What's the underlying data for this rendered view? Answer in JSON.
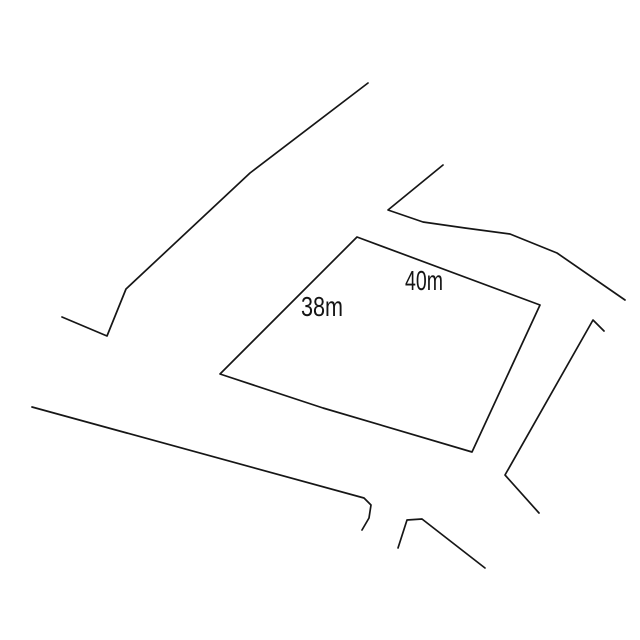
{
  "canvas": {
    "width": 640,
    "height": 640,
    "background": "#ffffff"
  },
  "drawing": {
    "description": "land-parcel-sketch",
    "stroke_color": "#161616",
    "stroke_width": 1.7,
    "polylines": [
      {
        "name": "road-line-upper-left",
        "closed": false,
        "points": [
          [
            368,
            83
          ],
          [
            250,
            173
          ],
          [
            126,
            289
          ],
          [
            107,
            336
          ],
          [
            62,
            317
          ]
        ]
      },
      {
        "name": "road-line-upper-right",
        "closed": false,
        "points": [
          [
            443,
            165
          ],
          [
            388,
            210
          ],
          [
            423,
            222
          ],
          [
            465,
            228
          ],
          [
            510,
            234
          ],
          [
            557,
            253
          ],
          [
            625,
            300
          ]
        ]
      },
      {
        "name": "parcel-outline",
        "closed": true,
        "points": [
          [
            357,
            237
          ],
          [
            540,
            305
          ],
          [
            472,
            452
          ],
          [
            323,
            408
          ],
          [
            220,
            374
          ]
        ]
      },
      {
        "name": "road-line-bottom",
        "closed": false,
        "points": [
          [
            32,
            407
          ],
          [
            364,
            498
          ],
          [
            371,
            505
          ],
          [
            369,
            518
          ],
          [
            362,
            530
          ]
        ]
      },
      {
        "name": "road-line-right",
        "closed": false,
        "points": [
          [
            604,
            331
          ],
          [
            593,
            320
          ],
          [
            505,
            475
          ],
          [
            539,
            513
          ]
        ]
      },
      {
        "name": "road-line-bottom-right",
        "closed": false,
        "points": [
          [
            398,
            548
          ],
          [
            407,
            520
          ],
          [
            422,
            519
          ],
          [
            485,
            568
          ]
        ]
      }
    ],
    "labels": [
      {
        "name": "dimension-label-40m",
        "text": "40m",
        "x": 405,
        "y": 290,
        "textLength": 38
      },
      {
        "name": "dimension-label-38m",
        "text": "38m",
        "x": 301,
        "y": 316,
        "textLength": 42
      }
    ]
  }
}
